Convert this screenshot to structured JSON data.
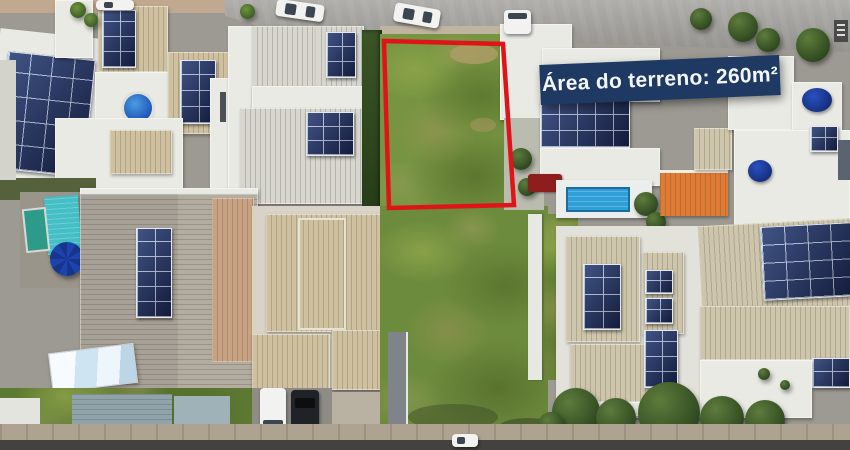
{
  "banner": {
    "label": "Área do terreno: 260m²",
    "bg_color": "#1e3a63",
    "text_color": "#f4f7fa"
  },
  "lot": {
    "outline_color": "#e01418"
  },
  "palette": {
    "grass_green": "#6d8b3d",
    "lot_grass_green": "#769441",
    "street_gray": "#a3a19c",
    "road_dark": "#43423e",
    "sidewalk_tan": "#ada390",
    "roof_white": "#e9eae4",
    "roof_tan": "#cfc1a0",
    "roof_gray": "#b2aca1",
    "roof_orange": "#df7b35",
    "solar_panel_navy": "#1c2a50",
    "pool_blue": "#2f9fd8",
    "pool_teal": "#45bfc6",
    "umbrella_blue": "#1d44ae",
    "water_heater_teal": "#2e9b8a",
    "red_carport": "#8e1d1d",
    "tree_green": "#3e5c28"
  }
}
